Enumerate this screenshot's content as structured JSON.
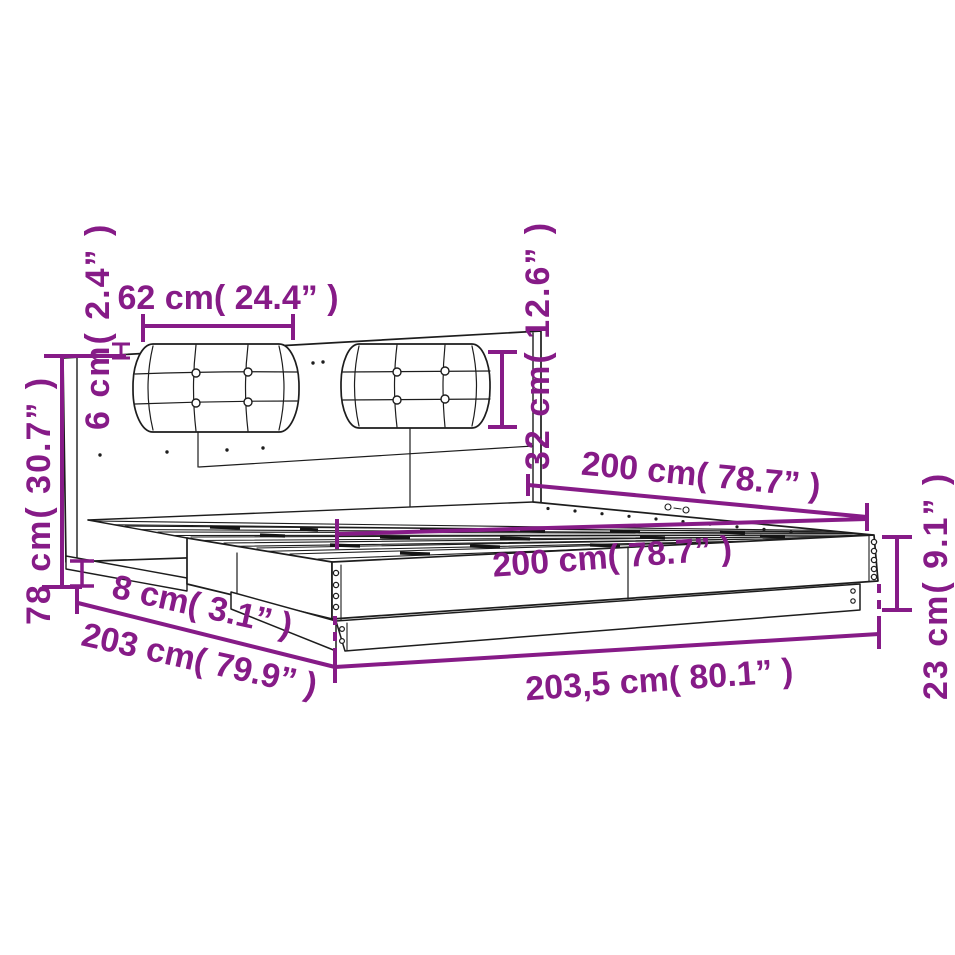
{
  "page": {
    "background": "#ffffff"
  },
  "diagram": {
    "accent_color": "#861b87",
    "line_color": "#1d1d1d",
    "dims": {
      "cushion_width": "62 cm( 24.4” )",
      "cushion_thickness": "6 cm( 2.4” )",
      "headboard_height": "78 cm( 30.7” )",
      "cushion_height": "32 cm( 12.6” )",
      "bed_length": "200 cm( 78.7” )",
      "bed_width": "200 cm( 78.7” )",
      "rail_height": "8 cm( 3.1” )",
      "frame_length": "203 cm( 79.9” )",
      "total_length": "203,5 cm( 80.1” )",
      "frame_height": "23 cm( 9.1” )"
    }
  }
}
